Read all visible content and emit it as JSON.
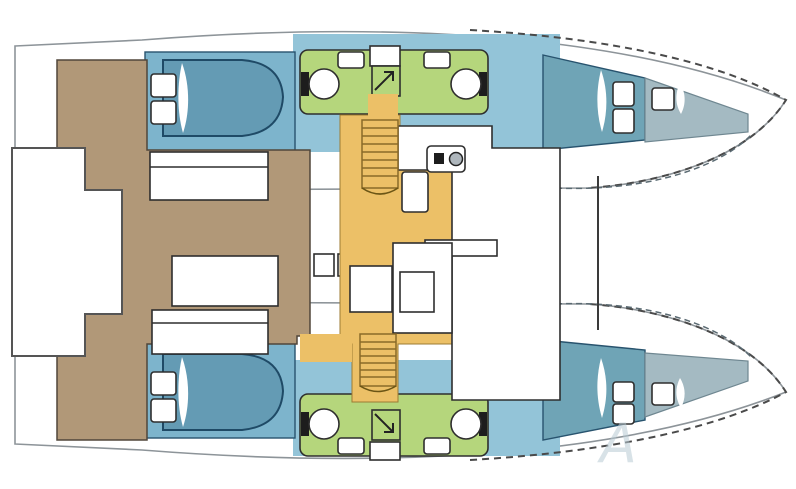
{
  "diagram": {
    "kind": "catamaran-yacht-floor-plan",
    "watermark_letter": "A"
  },
  "colors": {
    "cockpit-brown": "#b19878",
    "salon-orange": "#ecc067",
    "cabin-blue": "#7db4cc",
    "corridor-blue": "#93c4d8",
    "bed-blue": "#649bb4",
    "bed-outline": "#1f4a66",
    "forward-teal": "#6fa4b6",
    "forepeak-gray": "#a4bac2",
    "head-green": "#b5d67c",
    "hull-stroke": "#8d9499",
    "outline-dark": "#2e2e2e",
    "cabin-outline": "#28536e",
    "wood-line": "#8a6a28",
    "watermark": "#b9cbd4"
  },
  "regions": {
    "port_hull": [
      "aft-cabin-with-double-bed",
      "bathroom-head",
      "forward-cabin",
      "forepeak-locker"
    ],
    "starboard_hull": [
      "aft-cabin-with-double-bed",
      "bathroom-head",
      "forward-cabin",
      "forepeak-locker"
    ],
    "center": [
      "salon-galley",
      "chart-table",
      "stairs-to-hulls",
      "forward-beam",
      "trampoline-gap"
    ],
    "stern": [
      "cockpit-with-benches",
      "cockpit-table",
      "transom-platform"
    ]
  }
}
